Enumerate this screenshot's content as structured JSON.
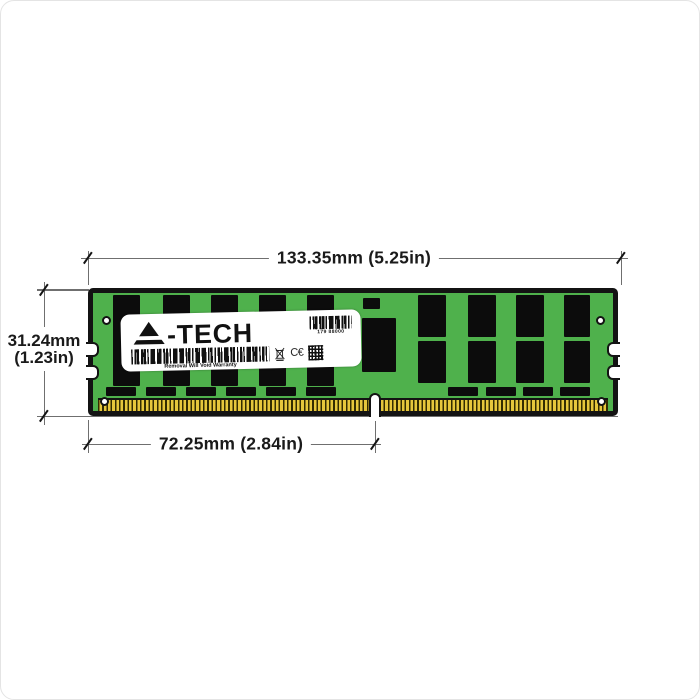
{
  "canvas": {
    "background": "#ffffff",
    "border_color": "#e4e4e4"
  },
  "dimensions": {
    "width": {
      "label": "133.35mm (5.25in)"
    },
    "height": {
      "line1": "31.24mm",
      "line2": "(1.23in)"
    },
    "pin_width": {
      "label": "72.25mm (2.84in)"
    },
    "line_color": "#6f6f6f",
    "text_color": "#1a1a1a"
  },
  "module": {
    "type": "RDIMM memory module illustration",
    "colors": {
      "pcb_green": "#4fb14c",
      "chip_black": "#0c0c0c",
      "pin_gold": "#e6c63c",
      "outline": "#131313",
      "label_white": "#ffffff"
    },
    "label": {
      "brand": "A-TECH",
      "brand_suffix": "-TECH",
      "serial": "179 88000",
      "warranty": "Removal Will Void Warranty",
      "ce_mark": "C€"
    }
  }
}
